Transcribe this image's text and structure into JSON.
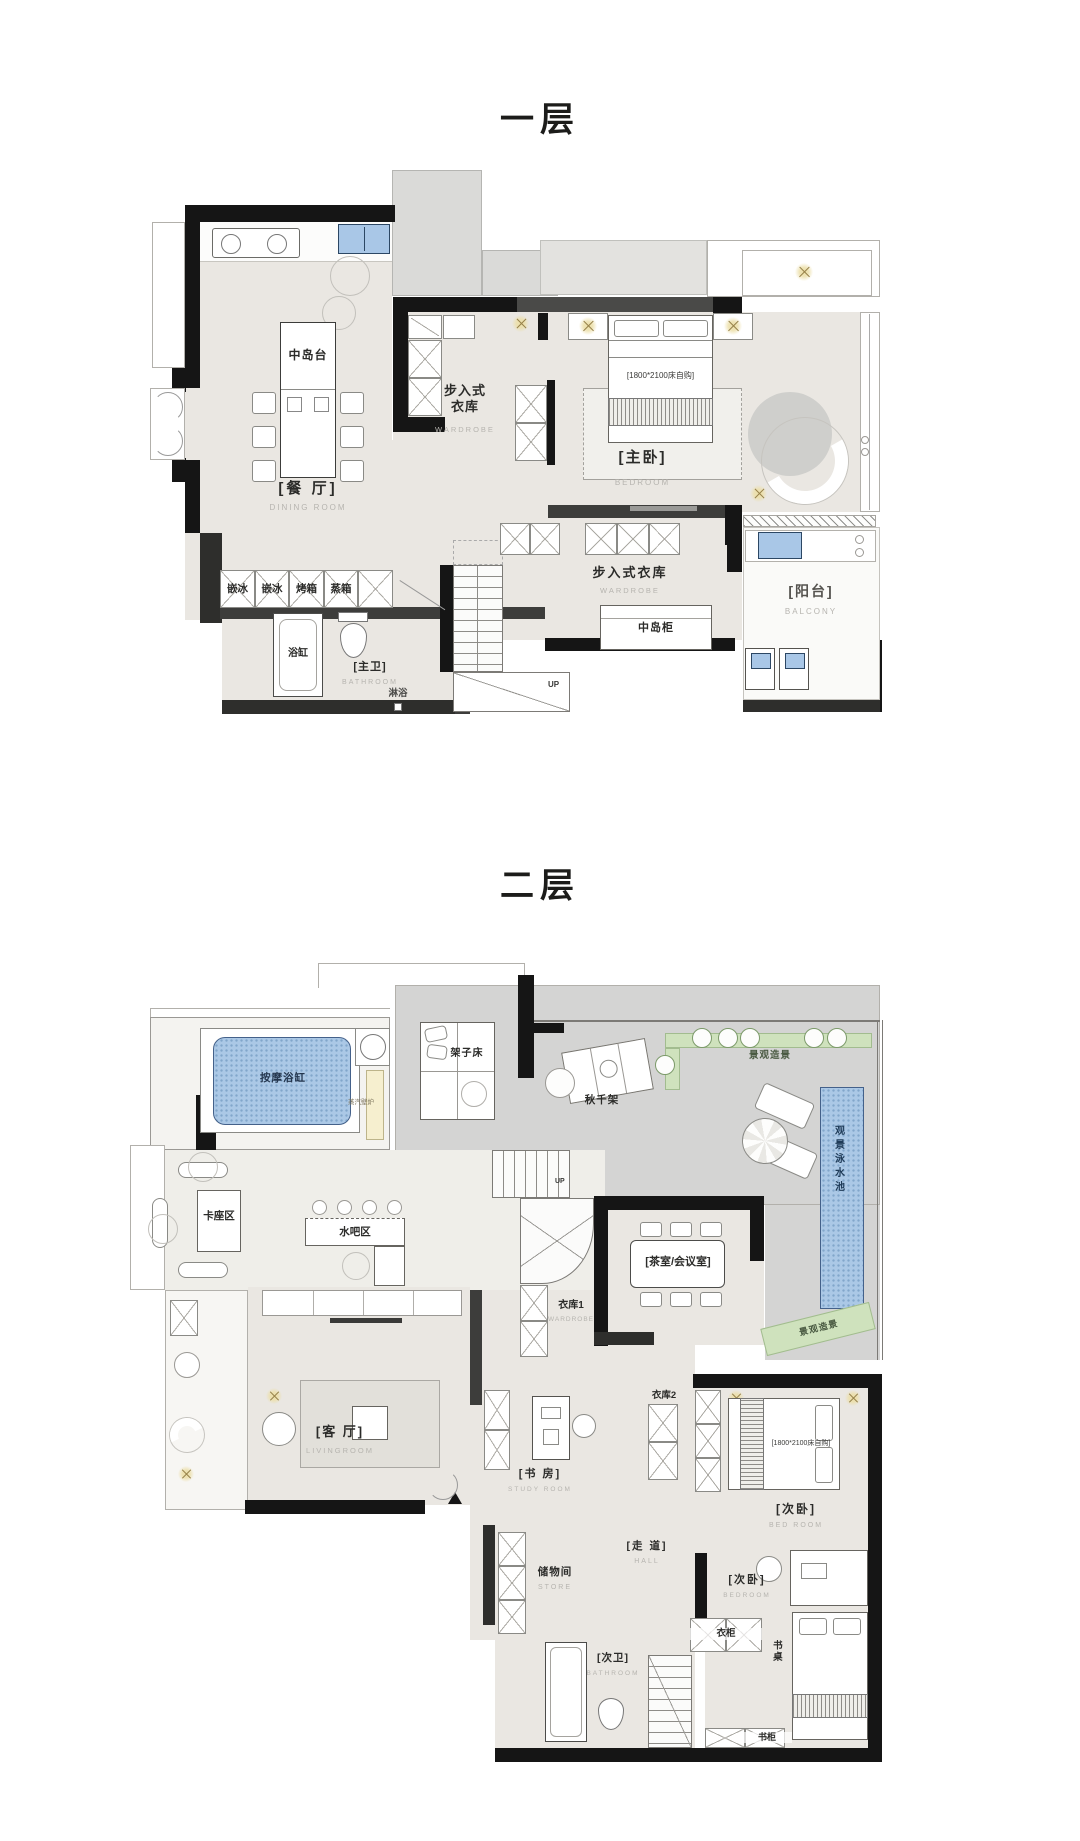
{
  "colors": {
    "wall": "#151515",
    "floor_warm": "#eae7e2",
    "terrace_gray": "#d4d4d3",
    "water_blue": "#abc8e6",
    "landscape_green": "#cfe2bd",
    "accent_gold": "#ecdfa9"
  },
  "floor1": {
    "title": "一层",
    "labels": {
      "island": "中岛台",
      "dining_cn": "[餐 厅]",
      "dining_en": "DINING ROOM",
      "appliances": [
        "嵌冰",
        "嵌冰",
        "烤箱",
        "蒸箱"
      ],
      "bathtub": "浴缸",
      "master_bath_cn": "[主卫]",
      "master_bath_en": "BATHROOM",
      "shower": "淋浴",
      "wardrobe_top_cn": "步入式\n衣库",
      "wardrobe_top_en": "WARDROBE",
      "bed_note": "[1800*2100床自购]",
      "master_cn": "[主卧]",
      "master_en": "BEDROOM",
      "wardrobe2_cn": "步入式衣库",
      "wardrobe2_en": "WARDROBE",
      "island_cabinet": "中岛柜",
      "balcony_cn": "[阳台]",
      "balcony_en": "BALCONY",
      "up": "UP"
    }
  },
  "floor2": {
    "title": "二层",
    "labels": {
      "massage_tub": "按摩浴缸",
      "steam_fireplace": "蒸汽壁炉",
      "frame_bed": "架子床",
      "swing": "秋千架",
      "landscape_top": "景观造景",
      "landscape_right": "景观造景",
      "pool": "观景泳水池",
      "booth": "卡座区",
      "bar": "水吧区",
      "up": "UP",
      "wardrobe1": "衣库1",
      "wardrobe1_en": "WARDROBE",
      "tea_room": "[茶室/会议室]",
      "living_cn": "[客 厅]",
      "living_en": "LIVINGROOM",
      "study_cn": "[书 房]",
      "study_en": "STUDY ROOM",
      "wardrobe2": "衣库2",
      "bed_note": "[1800*2100床自购]",
      "bedroom2_cn": "[次卧]",
      "bedroom2_en": "BED ROOM",
      "bedroom3_cn": "[次卧]",
      "bedroom3_en": "BEDROOM",
      "store_cn": "储物间",
      "store_en": "STORE",
      "hall_cn": "[走 道]",
      "hall_en": "HALL",
      "bath2_cn": "[次卫]",
      "bath2_en": "BATHROOM",
      "closet": "衣柜",
      "desk": "书桌",
      "bookshelf": "书柜"
    }
  }
}
